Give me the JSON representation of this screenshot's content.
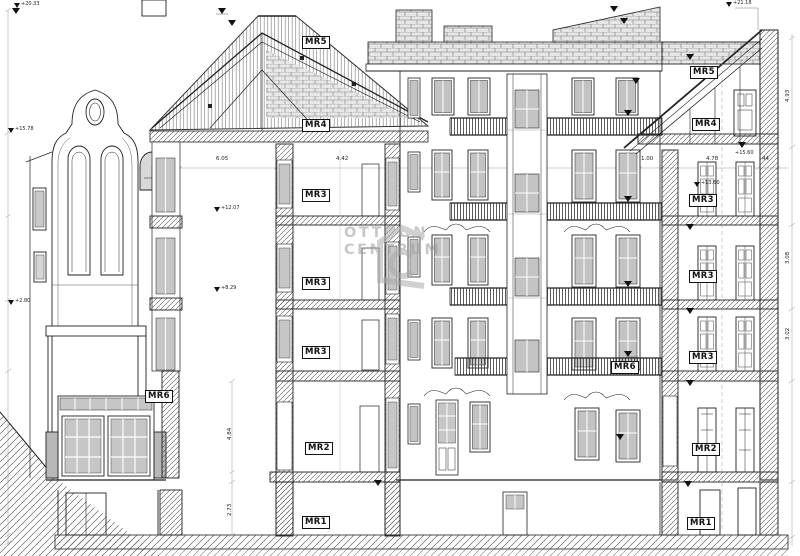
{
  "drawing": {
    "type": "architectural cross-section / elevation of residential building",
    "line_color": "#222222",
    "glazing_color": "#c3c3c3",
    "background": "#ffffff"
  },
  "watermark": {
    "logo": "otthon-centrum-house-logo",
    "line1": "OTTHON",
    "line2": "CENTRUM",
    "color": "#9a9a9a"
  },
  "rooms": [
    {
      "label": "MR5"
    },
    {
      "label": "MR4"
    },
    {
      "label": "MR3"
    },
    {
      "label": "MR3"
    },
    {
      "label": "MR3"
    },
    {
      "label": "MR2"
    },
    {
      "label": "MR1"
    },
    {
      "label": "MR6"
    },
    {
      "label": "MR6"
    },
    {
      "label": "MR5"
    },
    {
      "label": "MR4"
    },
    {
      "label": "MR3"
    },
    {
      "label": "MR3"
    },
    {
      "label": "MR3"
    },
    {
      "label": "MR2"
    },
    {
      "label": "MR1"
    }
  ],
  "markers": [
    {
      "value": "+20.33"
    },
    {
      "value": "+15.78"
    },
    {
      "value": "+12.07"
    },
    {
      "value": "+8.29"
    },
    {
      "value": "+2.80"
    },
    {
      "value": "+21.18"
    },
    {
      "value": "+13.60"
    },
    {
      "value": "+15.60"
    }
  ],
  "dimensions": {
    "h": [
      "6.05",
      "4.42",
      "1.00",
      "4.78",
      "44"
    ],
    "v_center": [
      "4.84",
      "2.73"
    ],
    "v_right": [
      "4.93",
      "3.08",
      "3.02"
    ]
  }
}
